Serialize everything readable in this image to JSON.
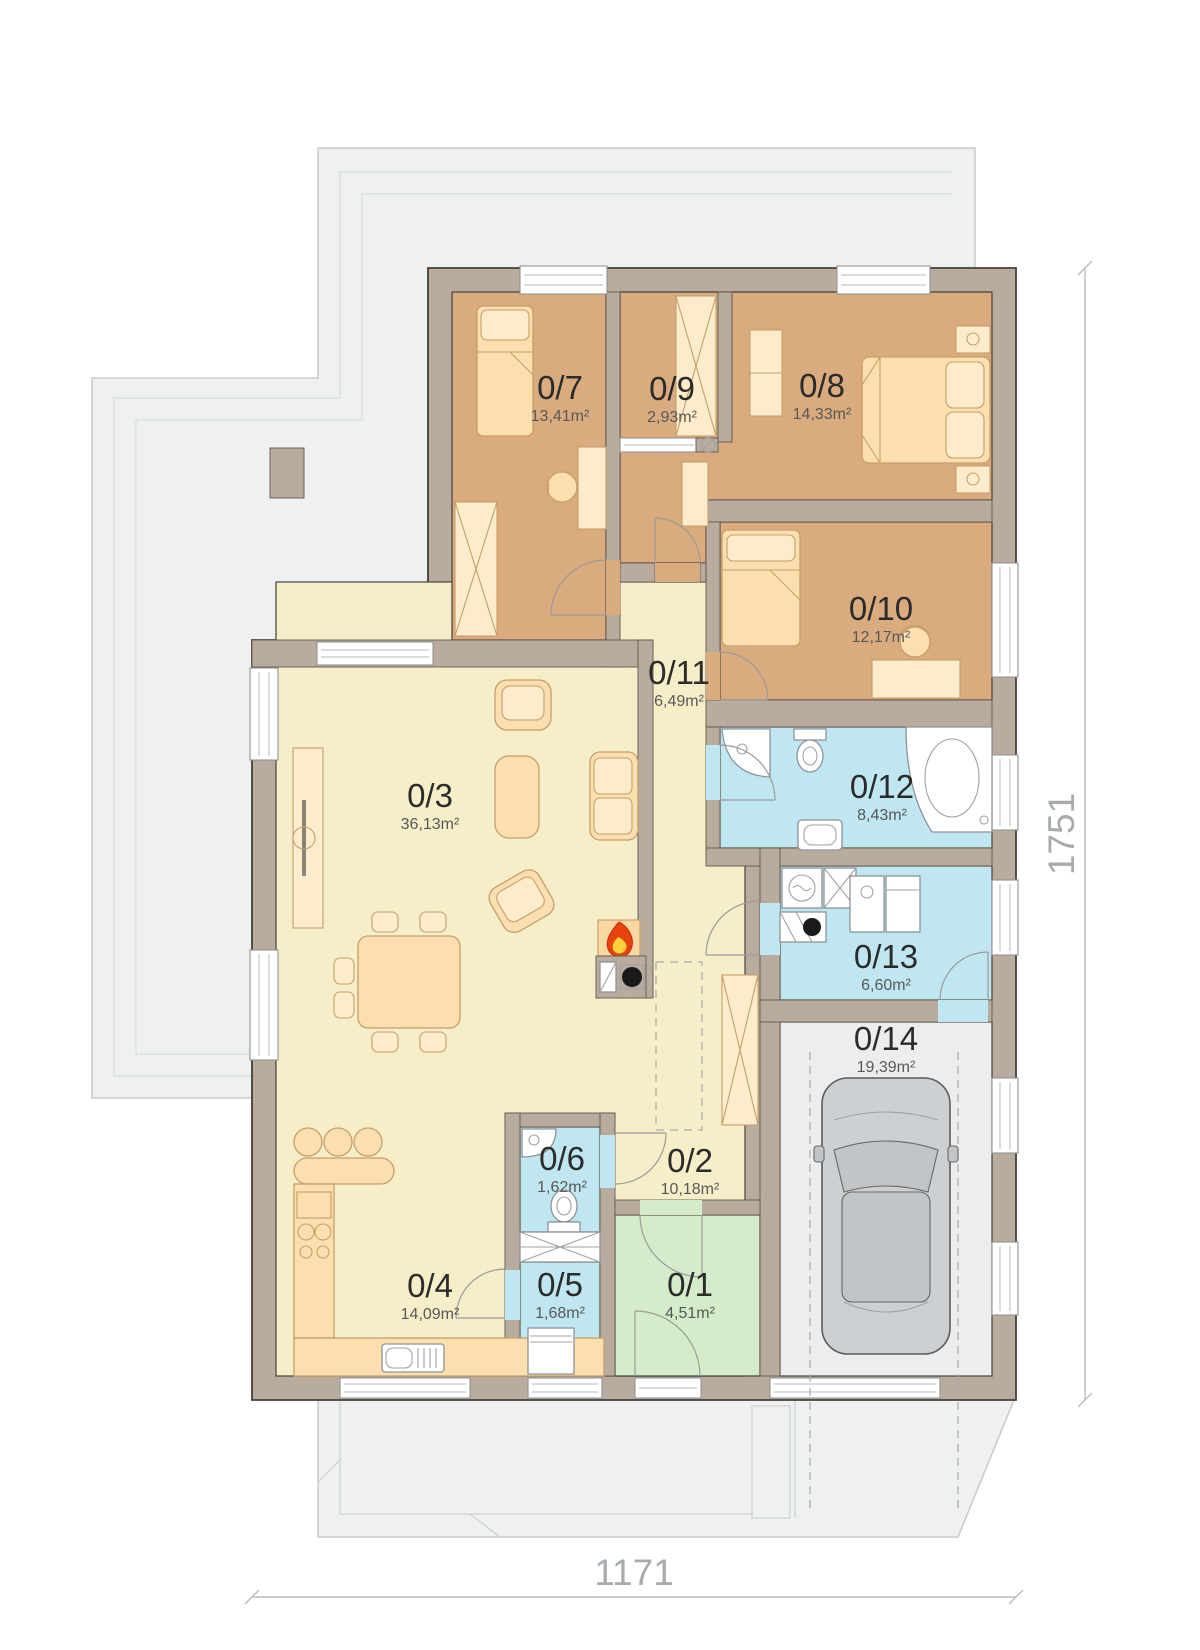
{
  "plan": {
    "dimensions": {
      "bottom": "1171",
      "right": "1751"
    },
    "rooms": {
      "r1": {
        "number": "0/1",
        "area": "4,51m²"
      },
      "r2": {
        "number": "0/2",
        "area": "10,18m²"
      },
      "r3": {
        "number": "0/3",
        "area": "36,13m²"
      },
      "r4": {
        "number": "0/4",
        "area": "14,09m²"
      },
      "r5": {
        "number": "0/5",
        "area": "1,68m²"
      },
      "r6": {
        "number": "0/6",
        "area": "1,62m²"
      },
      "r7": {
        "number": "0/7",
        "area": "13,41m²"
      },
      "r8": {
        "number": "0/8",
        "area": "14,33m²"
      },
      "r9": {
        "number": "0/9",
        "area": "2,93m²"
      },
      "r10": {
        "number": "0/10",
        "area": "12,17m²"
      },
      "r11": {
        "number": "0/11",
        "area": "6,49m²"
      },
      "r12": {
        "number": "0/12",
        "area": "8,43m²"
      },
      "r13": {
        "number": "0/13",
        "area": "6,60m²"
      },
      "r14": {
        "number": "0/14",
        "area": "19,39m²"
      }
    },
    "colors": {
      "wall": "#b9ac9f",
      "bedroom": "#d9ab7e",
      "living": "#f6eec9",
      "bathroom": "#c0e6f2",
      "entry": "#d4ecca",
      "garage": "#ecedee",
      "terrace": "#eef0f1",
      "flame": "#e8420e"
    }
  }
}
